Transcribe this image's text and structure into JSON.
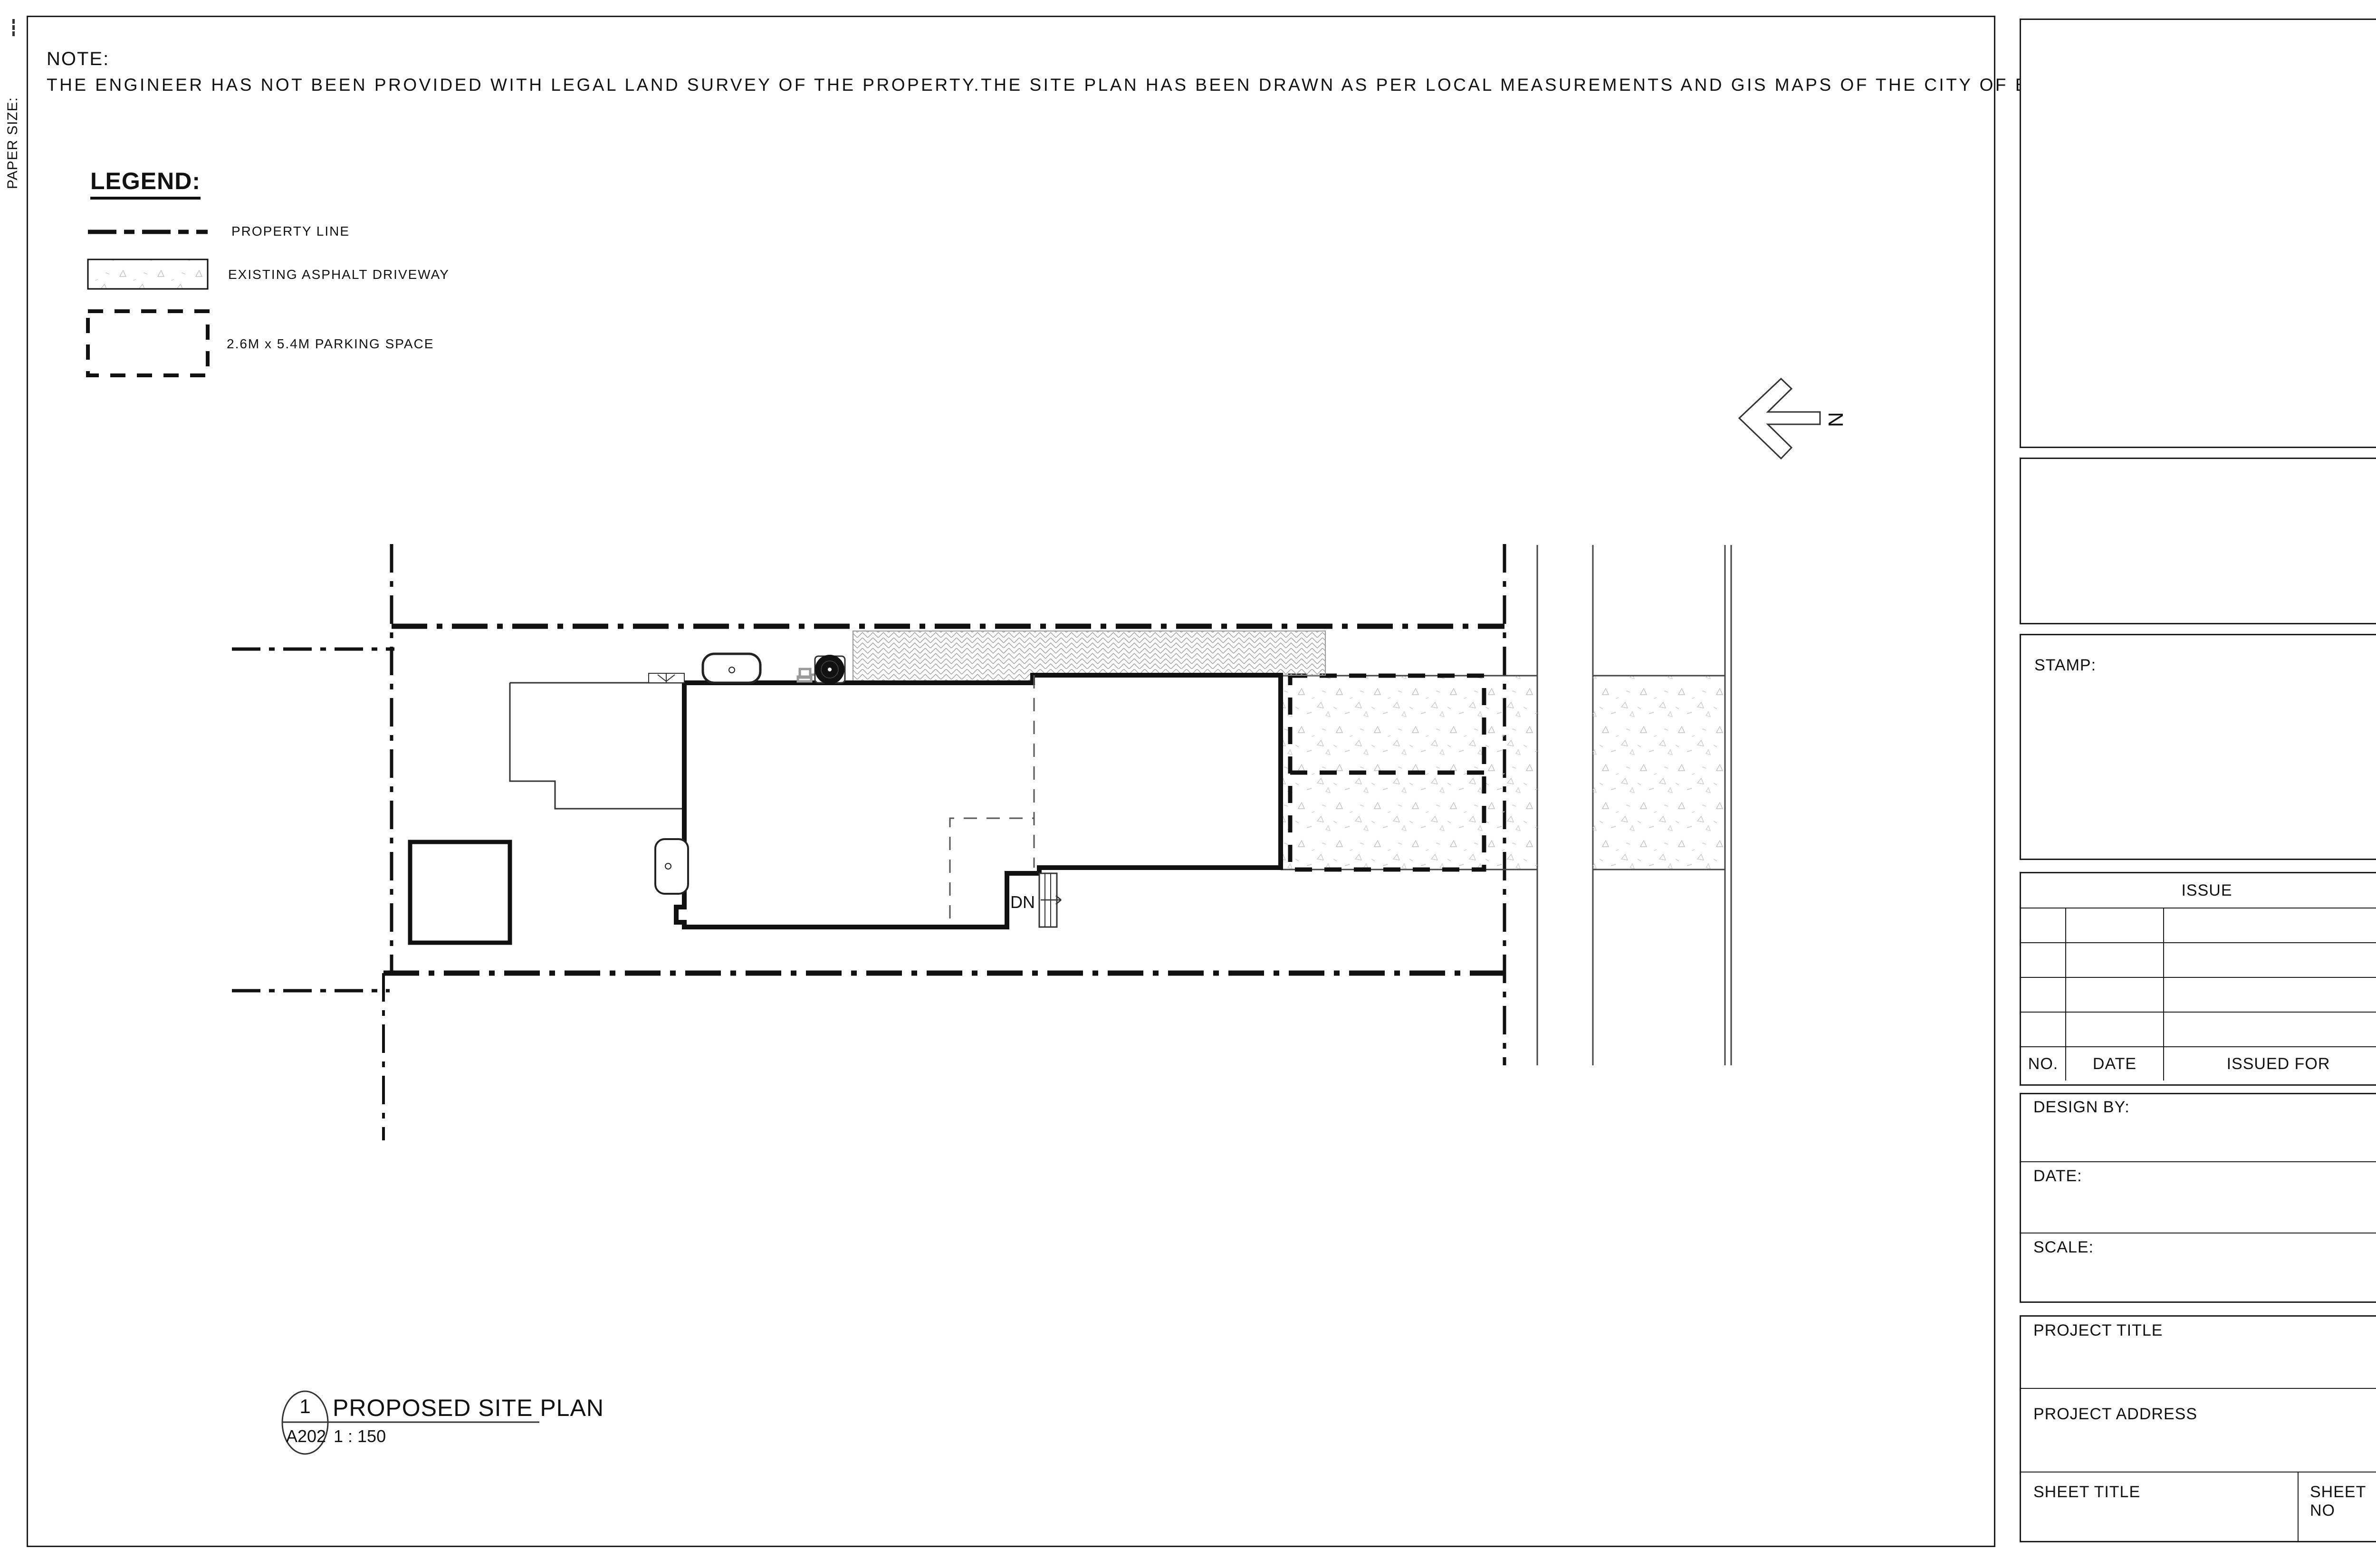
{
  "sheet": {
    "paper_size_label": "PAPER SIZE:",
    "note": {
      "title": "NOTE:",
      "body": "THE ENGINEER HAS NOT BEEN PROVIDED WITH LEGAL LAND SURVEY OF THE PROPERTY.THE SITE PLAN HAS BEEN DRAWN AS PER LOCAL MEASUREMENTS AND GIS MAPS OF THE CITY OF BRAMPTON."
    },
    "legend": {
      "title": "LEGEND:",
      "items": [
        {
          "label": "PROPERTY LINE",
          "symbol": "dash-dot-line"
        },
        {
          "label": "EXISTING ASPHALT DRIVEWAY",
          "symbol": "stipple-swatch"
        },
        {
          "label": "2.6M x 5.4M PARKING SPACE",
          "symbol": "dashed-rect"
        }
      ]
    },
    "north_label": "N",
    "plan": {
      "down_label": "DN"
    },
    "callout": {
      "number": "1",
      "sheet_ref": "A202",
      "title": "PROPOSED SITE PLAN",
      "scale": "1 : 150"
    },
    "titleblock": {
      "stamp_label": "STAMP:",
      "issue": {
        "header": "ISSUE",
        "col_no": "NO.",
        "col_date": "DATE",
        "col_issued_for": "ISSUED FOR",
        "blank_rows": 4
      },
      "design_by_label": "DESIGN BY:",
      "date_label": "DATE:",
      "scale_label": "SCALE:",
      "project_title_label": "PROJECT TITLE",
      "project_address_label": "PROJECT ADDRESS",
      "sheet_title_label": "SHEET TITLE",
      "sheet_no_label": "SHEET NO"
    }
  }
}
